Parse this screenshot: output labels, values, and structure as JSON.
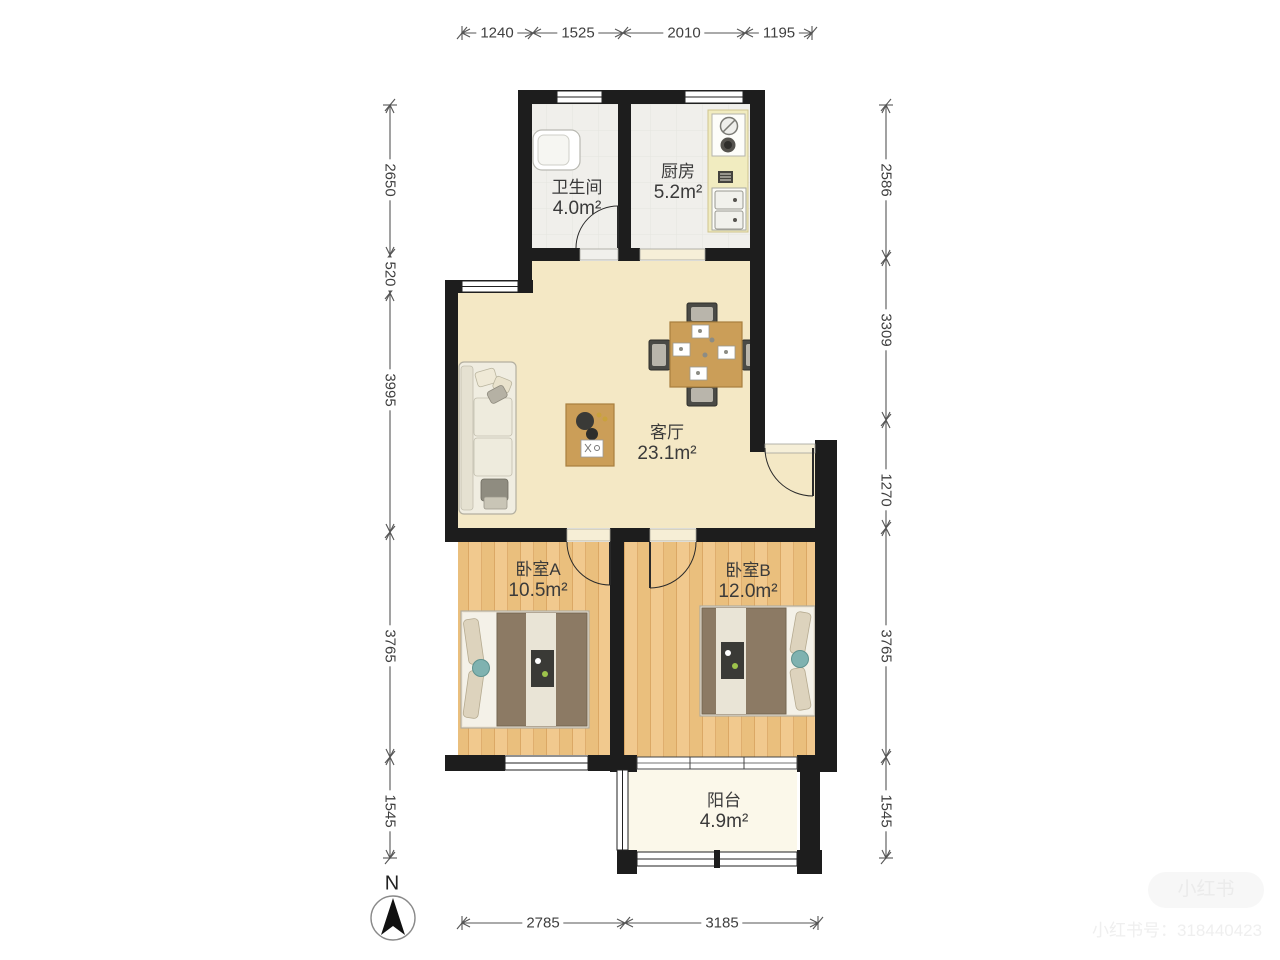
{
  "floorplan": {
    "rooms": {
      "bathroom": {
        "name": "卫生间",
        "area": "4.0m²"
      },
      "kitchen": {
        "name": "厨房",
        "area": "5.2m²"
      },
      "living_room": {
        "name": "客厅",
        "area": "23.1m²"
      },
      "bedroom_a": {
        "name": "卧室A",
        "area": "10.5m²"
      },
      "bedroom_b": {
        "name": "卧室B",
        "area": "12.0m²"
      },
      "balcony": {
        "name": "阳台",
        "area": "4.9m²"
      }
    },
    "dimensions_mm": {
      "top": [
        "1240",
        "1525",
        "2010",
        "1195"
      ],
      "left": [
        "2650",
        "520",
        "3995",
        "3765",
        "1545"
      ],
      "right": [
        "2586",
        "3309",
        "1270",
        "3765",
        "1545"
      ],
      "bottom": [
        "2785",
        "3185"
      ]
    },
    "compass": {
      "label": "N"
    },
    "watermark": {
      "badge": "小红书",
      "account": "小红书号：318440423"
    },
    "colors": {
      "wall": "#1d1d1d",
      "living_floor": "#f4e8c5",
      "wood_floor": "#eec287",
      "tile_floor": "#f0efeb",
      "balcony_floor": "#fbf8ea",
      "furniture_wood": "#cb9e58"
    }
  }
}
